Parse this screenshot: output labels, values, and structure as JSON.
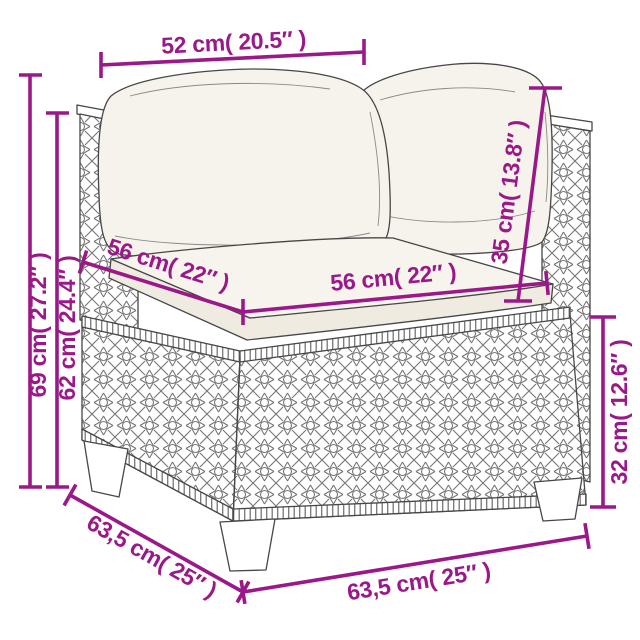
{
  "diagram": {
    "title": "Poly rattan corner sofa section dimension diagram",
    "background_color": "#FFFFFF",
    "dimension_color": "#9B1888",
    "sketch_color": "#474747",
    "cushion_color": "#F6F3EC"
  },
  "dimensions": {
    "top_width": "52 cm( 20.5″ )",
    "overall_height": "69 cm( 27.2″ )",
    "frame_height": "62 cm( 24.4″ )",
    "seat_depth": "56 cm( 22″ )",
    "seat_width": "56 cm( 22″ )",
    "back_cushion_height": "35 cm( 13.8″ )",
    "base_height": "32 cm( 12.6″ )",
    "overall_depth": "63,5 cm( 25″ )",
    "overall_width": "63,5 cm( 25″ )"
  }
}
